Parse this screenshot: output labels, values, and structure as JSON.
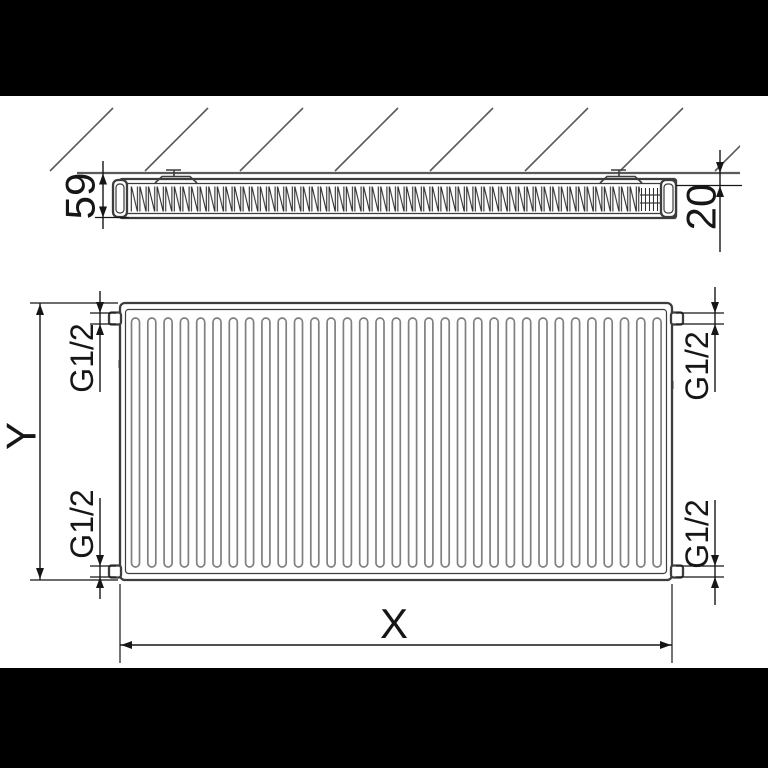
{
  "colors": {
    "letterbox": "#000000",
    "background": "#ffffff",
    "outline": "#3d3d3d",
    "fin_gray": "#7f7f7f",
    "wall": "#5a5a5a",
    "dimension": "#161616"
  },
  "side_view": {
    "depth_label": "59",
    "wall_gap_label": "20",
    "hatch_count": 8
  },
  "front_view": {
    "fin_count": 33,
    "width_label": "X",
    "height_label": "Y",
    "connections": {
      "top_left": "G1/2",
      "bottom_left": "G1/2",
      "top_right": "G1/2",
      "bottom_right": "G1/2"
    }
  }
}
